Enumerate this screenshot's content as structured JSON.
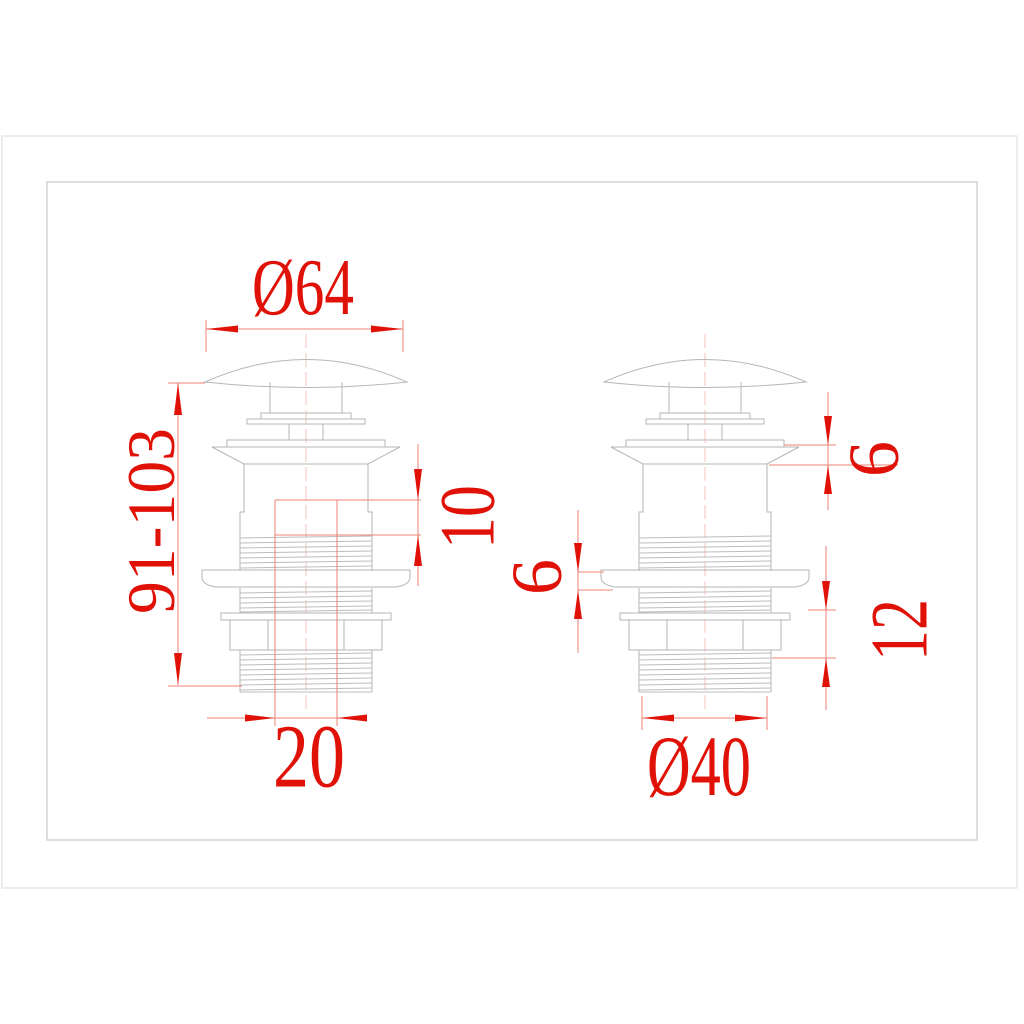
{
  "drawing": {
    "type": "technical-dimension-drawing",
    "subject": "pop-up basin waste drain, two views"
  },
  "colors": {
    "dimension_red": "#e01208",
    "extension_pink": "#ee8375",
    "drawing_gray": "#b6b6b6"
  },
  "labels": {
    "cap_diameter": "Ø64",
    "height_range": "91-103",
    "upper_thread_length": "10",
    "inner_tube_width": "20",
    "flange_height": "6",
    "gasket_thickness": "6",
    "locknut_section_height": "12",
    "thread_diameter": "Ø40"
  }
}
